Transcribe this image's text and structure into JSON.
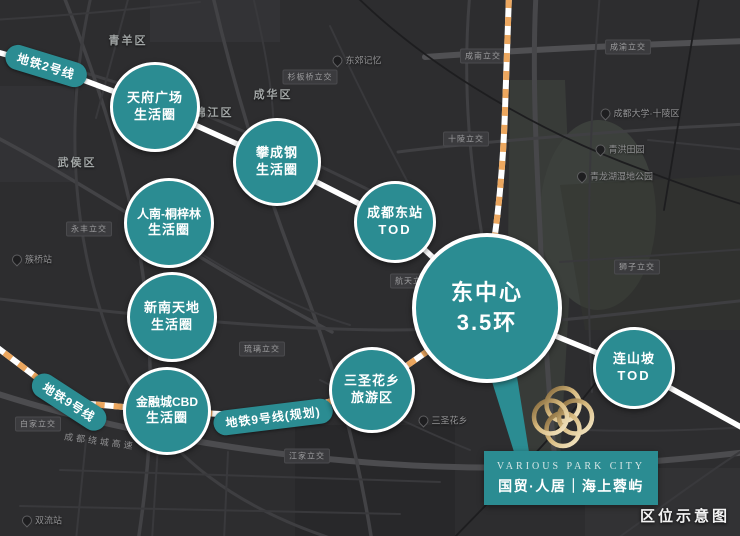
{
  "caption": "区位示意图",
  "colors": {
    "teal": "#2B8C92",
    "dash_orange": "#ECA75F",
    "map_background": "#2D2D2F",
    "gold": "#D8BC82"
  },
  "metro_badges": [
    {
      "label": "地铁2号线"
    },
    {
      "label": "地铁9号线"
    },
    {
      "label": "地铁9号线(规划)"
    }
  ],
  "circles": [
    {
      "line1": "天府广场",
      "line2": "生活圈"
    },
    {
      "line1": "攀成钢",
      "line2": "生活圈"
    },
    {
      "line1": "人南-桐梓林",
      "line2": "生活圈"
    },
    {
      "line1": "新南天地",
      "line2": "生活圈"
    },
    {
      "line1": "金融城CBD",
      "line2": "生活圈"
    },
    {
      "line1": "成都东站",
      "line2": "TOD"
    },
    {
      "line1": "东中心",
      "line2": "3.5环"
    },
    {
      "line1": "三圣花乡",
      "line2": "旅游区"
    },
    {
      "line1": "连山坡",
      "line2": "TOD"
    }
  ],
  "logo": {
    "brand_en": "VARIOUS PARK CITY",
    "brand_cn": "国贸·人居｜海上蓉屿"
  },
  "map_labels": {
    "districts": [
      "青羊区",
      "成华区",
      "锦江区",
      "武侯区"
    ],
    "interchanges": [
      "杉板桥立交",
      "成南立交",
      "成渝立交",
      "永丰立交",
      "白家立交",
      "琉璃立交",
      "江家立交",
      "狮子立交",
      "航天立交",
      "十陵立交"
    ],
    "highway": "成都绕城高速",
    "pois": [
      "东郊记忆",
      "成都大学·十陵区",
      "青洪田园",
      "青龙湖湿地公园",
      "三圣花乡",
      "双流站",
      "簇桥站"
    ]
  }
}
